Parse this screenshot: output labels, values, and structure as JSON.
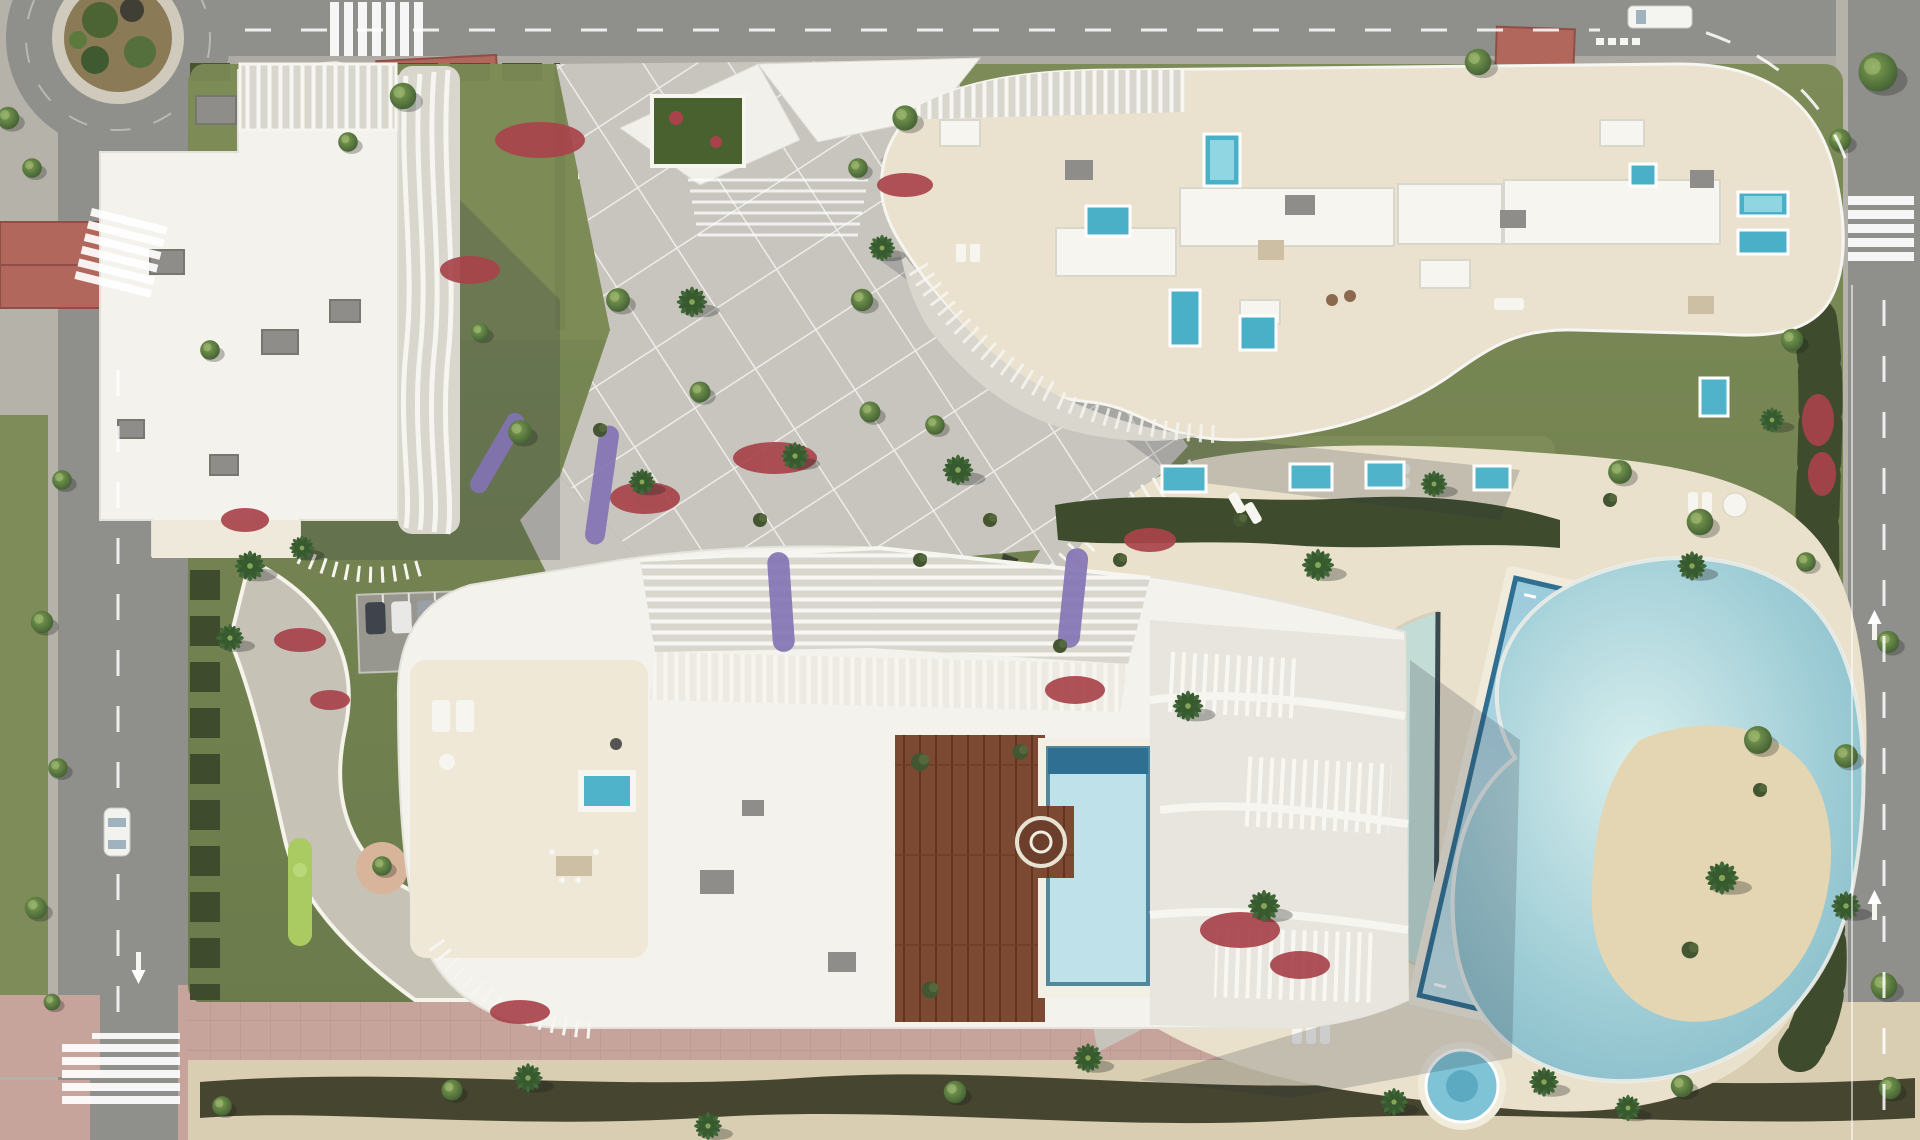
{
  "scene": {
    "title": "Aerial top-down render of a residential resort complex with three white apartment buildings, landscaped gardens and a communal pool area",
    "setting": "Daytime bird's-eye architectural visualization bounded by city roads on the top, left and right, with a sandy promenade strip along the bottom",
    "palette": {
      "asphalt": "#8f8f8c",
      "sidewalk": "#b5b2aa",
      "pinkpave": "#c7a49b",
      "lawn": "#72814f",
      "lawnlight": "#7d8c58",
      "hedge": "#3e4c2d",
      "hedgedark": "#46452f",
      "paving": "#c7c5bd",
      "gravel": "#c6c2b6",
      "deckcream": "#e9e1cb",
      "sand": "#d9ceb2",
      "building": "#f3f2ec",
      "roofcream": "#eae2cf",
      "louver": "#d9d6cd",
      "graybox": "#8e8d89",
      "wood": "#7c4a33",
      "water": "#7fc0d2",
      "waterdeep": "#2e6f92",
      "waterpale": "#c3ddd6",
      "island": "#e4d6b2",
      "flowersred": "#a8434b",
      "lavender": "#8374b4",
      "puttinggreen": "#aacb62",
      "sandpit": "#d8b49b",
      "redroof": "#b2675c",
      "treedark": "#3c5531",
      "palmgreen": "#42683a",
      "shadow": "#2b3140",
      "white": "#f6f5f0"
    },
    "elements": [
      {
        "name": "roundabout",
        "type": "traffic-circle with planted island"
      },
      {
        "name": "building-a",
        "type": "sculptural white tower with wavy louvre fins"
      },
      {
        "name": "building-b",
        "type": "long curved slab with rooftop terraces and plunge pools"
      },
      {
        "name": "building-c",
        "type": "low block with pergolas, wooden deck and rooftop pool"
      },
      {
        "name": "entrance-pavilion",
        "type": "angular white canopy at main plaza"
      },
      {
        "name": "central-plaza",
        "type": "diagonal gridded paving"
      },
      {
        "name": "lagoon-pool",
        "type": "free-form pool with sand island and palm"
      },
      {
        "name": "lap-pool",
        "type": "angled rectangular lane pool"
      },
      {
        "name": "leisure-pool",
        "type": "half-moon shallow pool"
      },
      {
        "name": "spa-pool",
        "type": "small round pool at deck edge"
      },
      {
        "name": "mini-golf",
        "type": "putting greens on lawn"
      },
      {
        "name": "parking-area",
        "type": "small surface car park"
      },
      {
        "name": "promenade",
        "type": "pink paved walk and sandy path with hedge"
      },
      {
        "name": "vehicles",
        "type": "white van on top road, white car on left road"
      }
    ],
    "counts": {
      "main_buildings": 3,
      "rooftop_plunge_pools_building_b": 7,
      "ground_floor_pools": 5,
      "communal_pools": 4
    }
  }
}
